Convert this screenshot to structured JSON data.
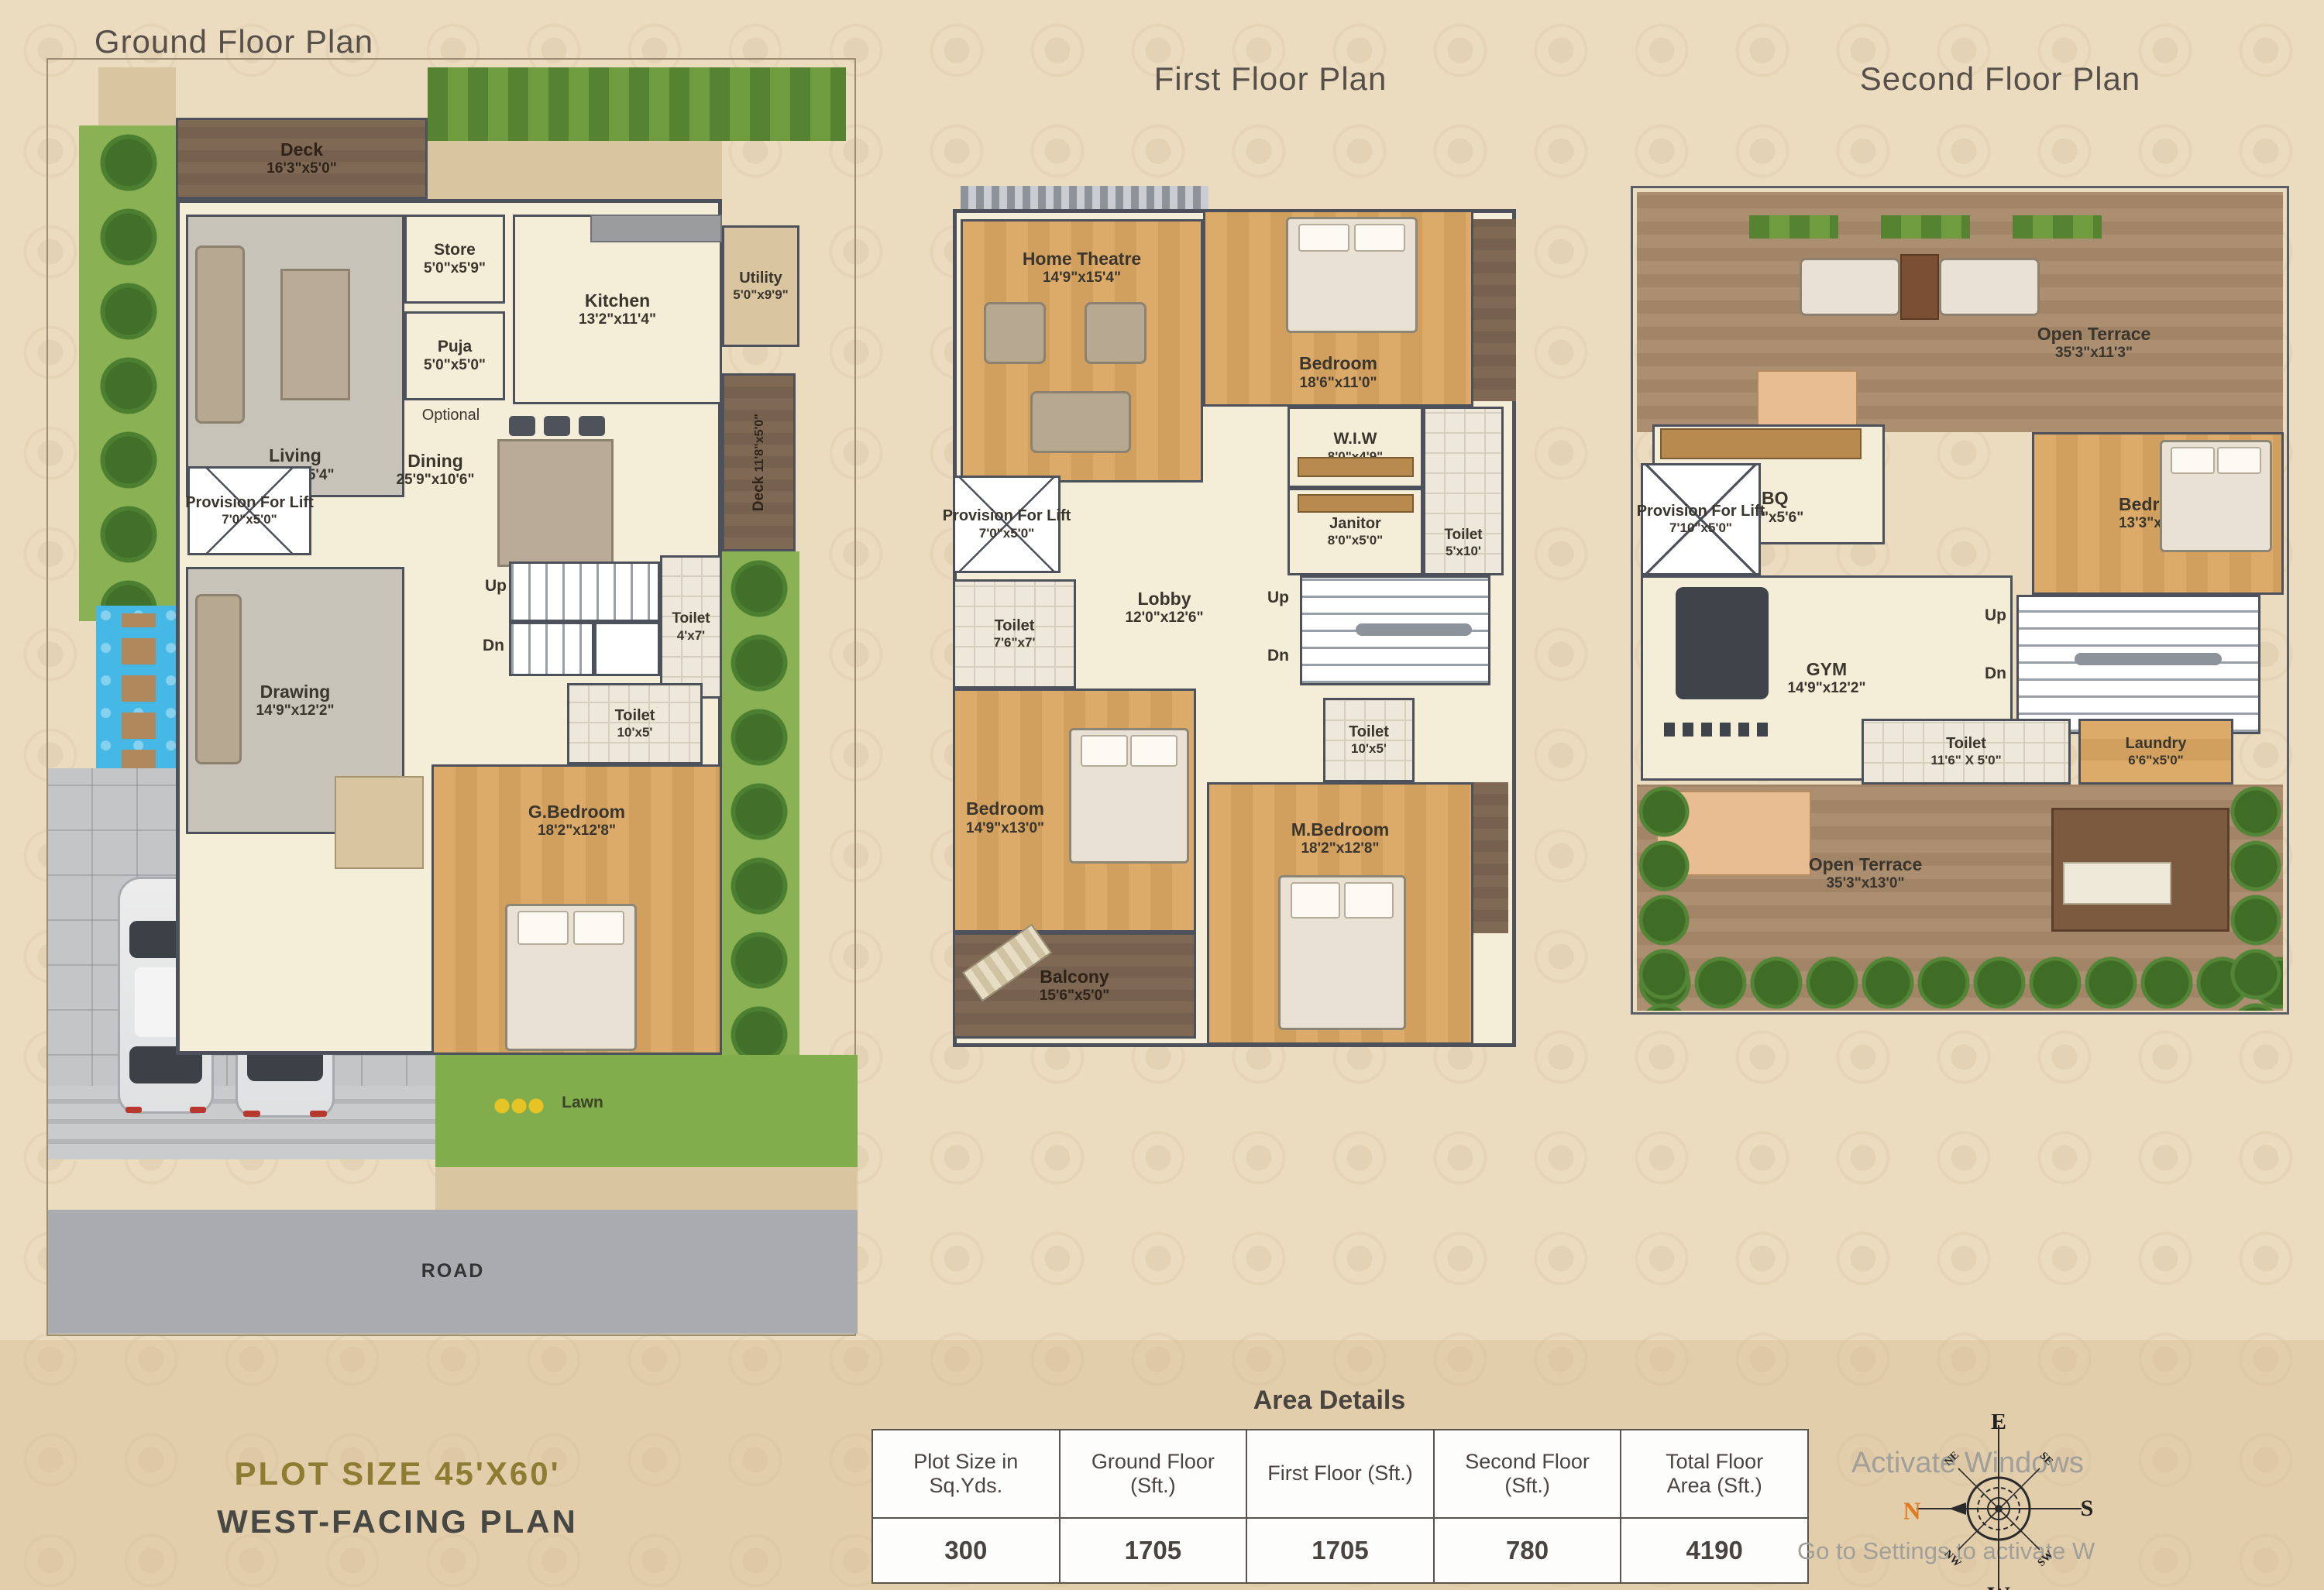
{
  "titles": {
    "ground": "Ground Floor Plan",
    "first": "First Floor Plan",
    "second": "Second Floor Plan"
  },
  "ground": {
    "deck_top": {
      "name": "Deck",
      "dims": "16'3\"x5'0\""
    },
    "living": {
      "name": "Living",
      "dims": "14'9\"x15'4\""
    },
    "store": {
      "name": "Store",
      "dims": "5'0\"x5'9\""
    },
    "puja": {
      "name": "Puja",
      "dims": "5'0\"x5'0\""
    },
    "optional_label": "Optional",
    "kitchen": {
      "name": "Kitchen",
      "dims": "13'2\"x11'4\""
    },
    "utility": {
      "name": "Utility",
      "dims": "5'0\"x9'9\""
    },
    "dining": {
      "name": "Dining",
      "dims": "25'9\"x10'6\""
    },
    "lift": {
      "name": "Provision For Lift",
      "dims": "7'0\"x5'0\""
    },
    "toilet_top": {
      "name": "Toilet",
      "dims": "4'x7'"
    },
    "toilet_mid": {
      "name": "Toilet",
      "dims": "10'x5'"
    },
    "drawing": {
      "name": "Drawing",
      "dims": "14'9\"x12'2\""
    },
    "g_bedroom": {
      "name": "G.Bedroom",
      "dims": "18'2\"x12'8\""
    },
    "deck_right": {
      "name": "Deck",
      "dims": "11'8\"x5'0\""
    },
    "up": "Up",
    "dn": "Dn",
    "lawn": "Lawn",
    "road": "ROAD"
  },
  "first": {
    "home_theatre": {
      "name": "Home Theatre",
      "dims": "14'9\"x15'4\""
    },
    "bedroom_top": {
      "name": "Bedroom",
      "dims": "18'6\"x11'0\""
    },
    "wiw": {
      "name": "W.I.W",
      "dims": "8'0\"x4'9\""
    },
    "janitor": {
      "name": "Janitor",
      "dims": "8'0\"x5'0\""
    },
    "toilet_right": {
      "name": "Toilet",
      "dims": "5'x10'"
    },
    "lift": {
      "name": "Provision For Lift",
      "dims": "7'0\"x5'0\""
    },
    "toilet_left": {
      "name": "Toilet",
      "dims": "7'6\"x7'"
    },
    "lobby": {
      "name": "Lobby",
      "dims": "12'0\"x12'6\""
    },
    "toilet_mid": {
      "name": "Toilet",
      "dims": "10'x5'"
    },
    "bedroom_left": {
      "name": "Bedroom",
      "dims": "14'9\"x13'0\""
    },
    "m_bedroom": {
      "name": "M.Bedroom",
      "dims": "18'2\"x12'8\""
    },
    "balcony": {
      "name": "Balcony",
      "dims": "15'6\"x5'0\""
    },
    "up": "Up",
    "dn": "Dn"
  },
  "second": {
    "open_terrace_top": {
      "name": "Open Terrace",
      "dims": "35'3\"x11'3\""
    },
    "bbq": {
      "name": "BBQ",
      "dims": "14'9\"x5'6\""
    },
    "bedroom": {
      "name": "Bedroom",
      "dims": "13'3\"x10'0\""
    },
    "lift": {
      "name": "Provision For Lift",
      "dims": "7'10\"x5'0\""
    },
    "gym": {
      "name": "GYM",
      "dims": "14'9\"x12'2\""
    },
    "toilet": {
      "name": "Toilet",
      "dims": "11'6\" X 5'0\""
    },
    "laundry": {
      "name": "Laundry",
      "dims": "6'6\"x5'0\""
    },
    "open_terrace_bottom": {
      "name": "Open Terrace",
      "dims": "35'3\"x13'0\""
    },
    "up": "Up",
    "dn": "Dn"
  },
  "footer": {
    "plot_size": "PLOT SIZE 45'X60'",
    "facing": "WEST-FACING PLAN"
  },
  "area_details": {
    "title": "Area Details",
    "columns": [
      "Plot Size in Sq.Yds.",
      "Ground Floor (Sft.)",
      "First Floor (Sft.)",
      "Second Floor (Sft.)",
      "Total Floor Area (Sft.)"
    ],
    "values": [
      "300",
      "1705",
      "1705",
      "780",
      "4190"
    ]
  },
  "compass": {
    "n": "N",
    "e": "E",
    "s": "S",
    "w": "W",
    "ne": "NE",
    "se": "SE",
    "sw": "SW",
    "nw": "NW"
  },
  "watermark": {
    "line1": "Activate Windows",
    "line2": "Go to Settings to activate W"
  },
  "colors": {
    "accent_n": "#e07b1f",
    "wall": "#4c515b",
    "lawn": "#82ad4c",
    "pool": "#45b8e6",
    "road": "#a9abae"
  }
}
